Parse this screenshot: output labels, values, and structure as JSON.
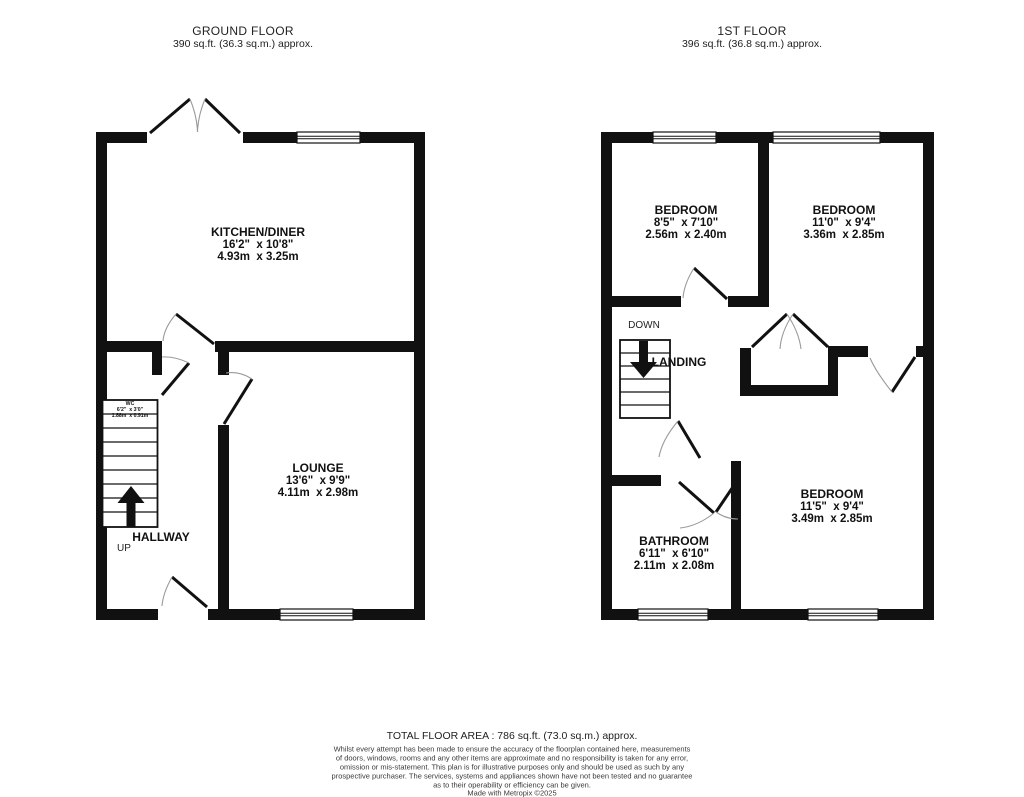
{
  "floorplan": {
    "colors": {
      "wall": "#111111",
      "text": "#1a1a1a"
    },
    "ground": {
      "title": "GROUND FLOOR",
      "area": "390 sq.ft. (36.3 sq.m.) approx.",
      "rooms": {
        "kitchen": {
          "name": "KITCHEN/DINER",
          "imperial": "16'2\"  x 10'8\"",
          "metric": "4.93m  x 3.25m"
        },
        "lounge": {
          "name": "LOUNGE",
          "imperial": "13'6\"  x 9'9\"",
          "metric": "4.11m  x 2.98m"
        },
        "wc": {
          "name": "WC",
          "imperial": "6'2\"  x 3'0\"",
          "metric": "1.88m  x 0.91m"
        }
      },
      "labels": {
        "hallway": "HALLWAY",
        "up": "UP"
      }
    },
    "first": {
      "title": "1ST FLOOR",
      "area": "396 sq.ft. (36.8 sq.m.) approx.",
      "rooms": {
        "bedroom1": {
          "name": "BEDROOM",
          "imperial": "8'5\"  x 7'10\"",
          "metric": "2.56m  x 2.40m"
        },
        "bedroom2": {
          "name": "BEDROOM",
          "imperial": "11'0\"  x 9'4\"",
          "metric": "3.36m  x 2.85m"
        },
        "bedroom3": {
          "name": "BEDROOM",
          "imperial": "11'5\"  x 9'4\"",
          "metric": "3.49m  x 2.85m"
        },
        "bathroom": {
          "name": "BATHROOM",
          "imperial": "6'11\"  x 6'10\"",
          "metric": "2.11m  x 2.08m"
        }
      },
      "labels": {
        "landing": "LANDING",
        "down": "DOWN"
      }
    },
    "footer": {
      "total_area": "TOTAL FLOOR AREA : 786 sq.ft. (73.0 sq.m.) approx.",
      "disclaimer": [
        "Whilst every attempt has been made to ensure the accuracy of the floorplan contained here, measurements",
        "of doors, windows, rooms and any other items are approximate and no responsibility is taken for any error,",
        "omission or mis-statement. This plan is for illustrative purposes only and should be used as such by any",
        "prospective purchaser. The services, systems and appliances shown have not been tested and no guarantee",
        "as to their operability or efficiency can be given."
      ],
      "credit": "Made with Metropix ©2025"
    }
  }
}
